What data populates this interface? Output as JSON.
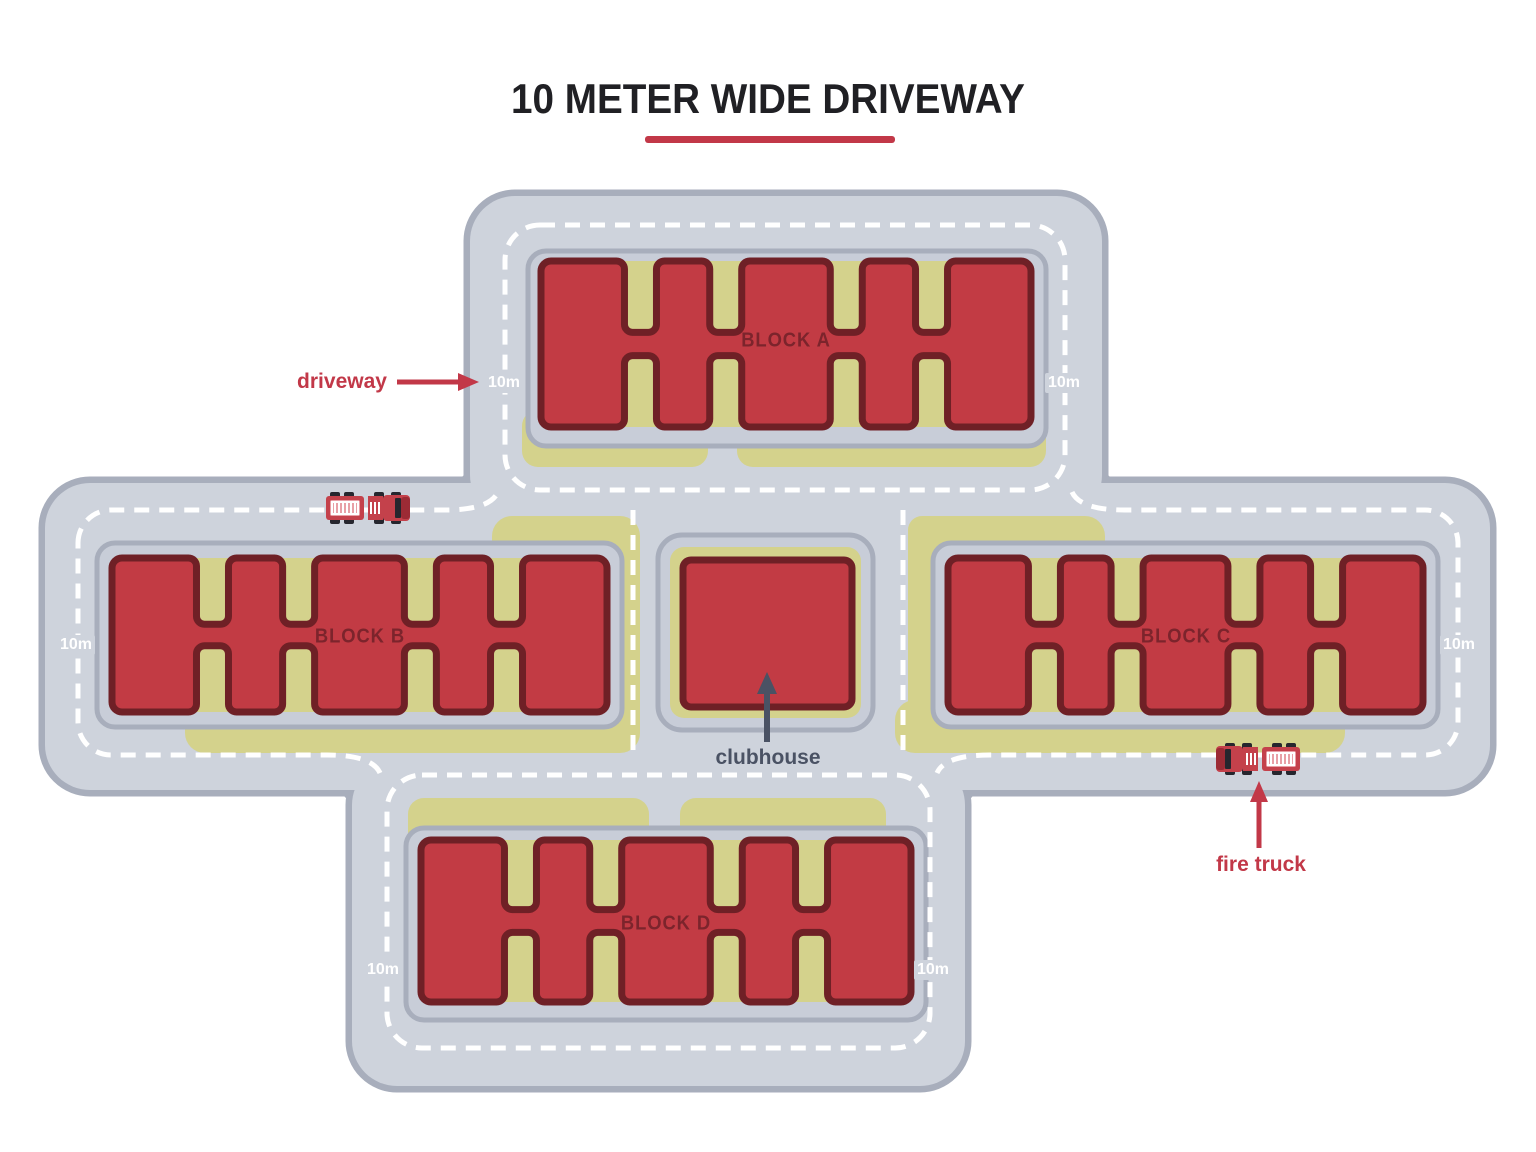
{
  "title": "10 METER WIDE DRIVEWAY",
  "labels": {
    "driveway": "driveway",
    "fire_truck": "fire truck",
    "clubhouse": "clubhouse",
    "distance": "10m"
  },
  "blocks": [
    {
      "label": "BLOCK A"
    },
    {
      "label": "BLOCK B"
    },
    {
      "label": "BLOCK C"
    },
    {
      "label": "BLOCK D"
    }
  ],
  "colors": {
    "background": "#ffffff",
    "road": "#ced3dc",
    "road_border": "#a8aebc",
    "pad": "#c8cdd8",
    "pad_border": "#a8aebc",
    "yard": "#d4d28c",
    "building": "#c23b44",
    "building_border": "#6f2026",
    "block_label": "#7c242c",
    "accent": "#c23848",
    "title_color": "#202024",
    "slate": "#4a5264",
    "dash": "#ffffff",
    "truck_body": "#c4414b",
    "truck_panel": "#e8a0a6",
    "truck_dark": "#9c2b35",
    "truck_glass": "#26262e"
  }
}
